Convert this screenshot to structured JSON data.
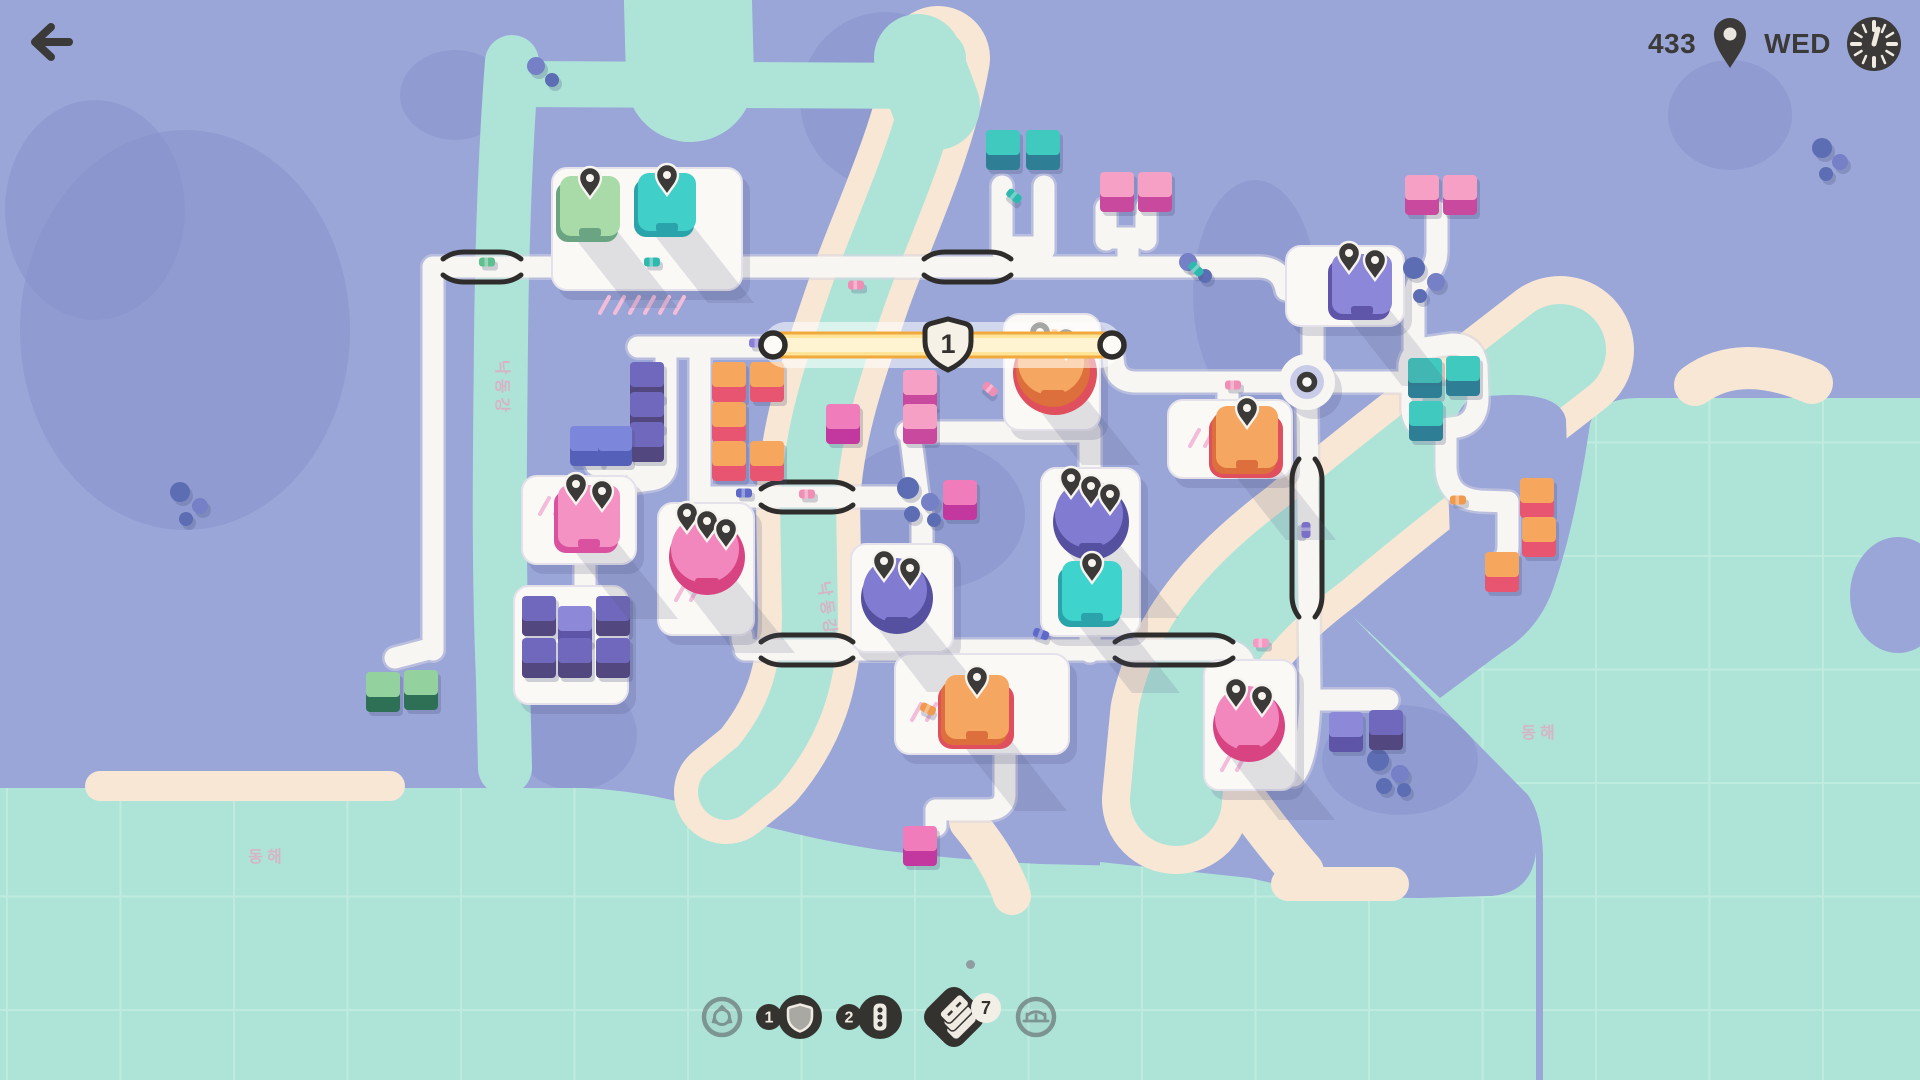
{
  "hud": {
    "back_glyph": "back-arrow",
    "pins_count": "433",
    "day": "WED"
  },
  "toolbar": {
    "items": [
      {
        "id": "roundabout-tool",
        "label": "Roundabout",
        "badge": "",
        "enabled": false
      },
      {
        "id": "motorway-tool",
        "label": "Motorway",
        "badge": "1",
        "enabled": true
      },
      {
        "id": "traffic-light-tool",
        "label": "Traffic Light",
        "badge": "2",
        "enabled": true
      },
      {
        "id": "road-tiles",
        "label": "Road Tiles",
        "badge": "7",
        "enabled": true
      },
      {
        "id": "bridge-tool",
        "label": "Bridge",
        "badge": "",
        "enabled": false
      }
    ]
  },
  "palette": {
    "land": "#9AA6D8",
    "hill": "#8690C9",
    "water": "#AEE4D8",
    "grid": "#C2EDE1",
    "sand": "#F7E7D4",
    "road": "#F8F6F2",
    "road_edge": "#D9D6E4",
    "lot": "#FBF9F6",
    "lot_stroke": "#E4E1EB",
    "dark": "#3B3A38",
    "rail": "#2E2D2B",
    "cream": "#F2EFE7",
    "label_pink": "#F295BC",
    "tree_a": "#5B6DB4",
    "tree_b": "#7480C6",
    "shadow_streak": "rgba(80,84,122,0.16)",
    "house_colors": {
      "pink": [
        "#F6A0C6",
        "#C8499E"
      ],
      "magenta": [
        "#F07CBC",
        "#C2399F"
      ],
      "orange": [
        "#F7A75D",
        "#E75570"
      ],
      "teal": [
        "#3FC9BE",
        "#2E7F96"
      ],
      "green": [
        "#93D19E",
        "#2F6F55"
      ],
      "indigo": [
        "#6F68BC",
        "#53477F"
      ],
      "purple": [
        "#8D88D8",
        "#5F55A8"
      ],
      "blue": [
        "#7B87DC",
        "#5560B8"
      ]
    },
    "dest_colors": {
      "green": [
        "#A9DBA8",
        "#6BA482"
      ],
      "teal": [
        "#41CFC9",
        "#2AA3AB"
      ],
      "tealSq": [
        "#3ED3CD",
        "#2AA3AB"
      ],
      "purple": [
        "#8C87D9",
        "#5F56A9"
      ],
      "purpleRd": [
        "#827BD2",
        "#55509F"
      ],
      "orange": [
        "#F5A660",
        "#DC6F3C"
      ],
      "pinkSq": [
        "#F592C4",
        "#D9519F"
      ],
      "pinkRd": [
        "#F287BE",
        "#D84381"
      ]
    }
  },
  "map": {
    "labels": [
      {
        "text": "동해",
        "x": 267,
        "y": 862,
        "rot": 0
      },
      {
        "text": "동해",
        "x": 1540,
        "y": 738,
        "rot": 0
      },
      {
        "text": "낙동강",
        "x": 497,
        "y": 388,
        "rot": 90
      },
      {
        "text": "낙동강",
        "x": 822,
        "y": 610,
        "rot": 82
      }
    ],
    "terrain": {
      "hills": [
        [
          185,
          330,
          165,
          200
        ],
        [
          95,
          210,
          90,
          110
        ],
        [
          885,
          100,
          85,
          88
        ],
        [
          1255,
          295,
          62,
          115
        ],
        [
          930,
          515,
          95,
          75
        ],
        [
          575,
          735,
          62,
          55
        ],
        [
          1400,
          760,
          78,
          55
        ],
        [
          1730,
          115,
          62,
          55
        ],
        [
          455,
          95,
          55,
          45
        ]
      ],
      "seas": [
        "M0,788 L585,788 Q655,792 715,812 Q800,838 880,850 Q960,860 1040,864 L1128,866 L1128,1080 L0,1080 Z",
        "M1100,1080 L1100,862 L1250,878 Q1330,898 1420,898 L1492,896 Q1532,892 1536,852 L1536,1080 Z",
        "M1352,616 L1528,795 Q1542,815 1543,855 L1543,1080 L1920,1080 L1920,398 L1640,398 Q1598,398 1590,424 Q1576,520 1556,580 Q1542,628 1502,652 L1440,698 Z"
      ],
      "sand": [
        {
          "d": "M938,58 C922,150 880,230 856,302 C830,378 812,432 808,502 L810,618 C809,680 793,724 758,766 L726,792",
          "w": 104
        },
        {
          "d": "M1560,350 C1470,420 1390,480 1312,546 C1240,600 1198,652 1184,716 L1176,800",
          "w": 148
        },
        {
          "d": "M100,786 L390,786",
          "w": 30
        },
        {
          "d": "M1288,884 L1392,884",
          "w": 34
        },
        {
          "d": "M1695,385 Q1740,352 1812,383",
          "w": 42
        },
        {
          "d": "M968,822 Q1000,860 1012,896",
          "w": 38
        },
        {
          "d": "M1238,790 Q1272,838 1302,872",
          "w": 44
        }
      ],
      "rivers": [
        {
          "d": "M512,62 C506,140 502,240 501,340 C500,450 498,560 503,680 L505,768",
          "w": 54
        },
        {
          "d": "M520,84 L930,86",
          "w": 46
        },
        {
          "d": "M688,2 L690,78",
          "w": 128
        },
        {
          "d": "M938,58 C922,150 880,230 856,302 C830,378 812,432 808,502 L810,618 C809,680 793,724 758,766 L726,792",
          "w": 56
        },
        {
          "d": "M918,58 L936,106",
          "w": 88
        },
        {
          "d": "M1560,350 C1470,420 1390,480 1312,546 C1240,600 1198,652 1184,716 L1176,800",
          "w": 92
        }
      ],
      "east_promontory": "M1472,398 Q1560,386 1566,420 Q1570,520 1554,580 Q1540,630 1498,638 Q1460,640 1452,600 L1448,480 Q1448,410 1472,398 Z",
      "right_blob": [
        1898,
        595,
        48,
        58
      ]
    },
    "trees": [
      [
        536,
        66,
        9
      ],
      [
        552,
        80,
        7
      ],
      [
        180,
        492,
        10
      ],
      [
        200,
        506,
        8
      ],
      [
        186,
        519,
        7
      ],
      [
        1414,
        268,
        11
      ],
      [
        1436,
        282,
        9
      ],
      [
        1420,
        296,
        7
      ],
      [
        908,
        488,
        11
      ],
      [
        930,
        502,
        9
      ],
      [
        912,
        514,
        8
      ],
      [
        934,
        520,
        7
      ],
      [
        1188,
        262,
        9
      ],
      [
        1205,
        276,
        7
      ],
      [
        1822,
        148,
        10
      ],
      [
        1840,
        162,
        8
      ],
      [
        1826,
        174,
        7
      ],
      [
        1378,
        760,
        11
      ],
      [
        1400,
        774,
        9
      ],
      [
        1384,
        786,
        8
      ],
      [
        1404,
        790,
        7
      ]
    ],
    "roads": [
      "M433,267 L1140,267",
      "M433,267 L433,650",
      "M433,648 L395,658",
      "M1002,186 L1002,250",
      "M1044,186 L1044,250",
      "M1002,247 L1044,247",
      "M1022,247 L1022,267",
      "M1106,208 L1106,240",
      "M1146,208 L1146,240",
      "M1106,238 L1146,238",
      "M1128,238 L1128,267",
      "M1140,267 L1258,267 Q1282,267 1286,290",
      "M1313,326 L1313,360",
      "M1281,382 L1136,382",
      "M1136,382 Q1118,382 1114,366 L1112,350",
      "M1333,382 L1410,382",
      "M1228,382 L1228,404",
      "M1412,384 Q1402,356 1424,348 L1452,344 Q1474,344 1477,366 L1478,398 Q1478,422 1458,427 L1434,430 Q1414,431 1412,410 Z",
      "M1446,430 L1446,466 Q1446,498 1480,501 L1508,502",
      "M1508,502 L1508,545 Q1508,560 1498,564",
      "M1437,212 L1437,250 Q1437,268 1424,276 Q1414,284 1414,302 L1414,348",
      "M1307,408 L1310,700",
      "M1310,700 L1388,700",
      "M1310,698 Q1308,760 1294,776",
      "M773,347 L638,347",
      "M666,347 L666,465",
      "M700,347 L700,506",
      "M666,465 L596,465",
      "M666,463 Q666,478 650,480 L636,482",
      "M700,504 Q700,516 690,518",
      "M705,497 L907,497",
      "M905,497 Q921,499 922,516 L922,546",
      "M907,432 L1090,432",
      "M910,432 L918,494",
      "M1090,432 L1090,470",
      "M1090,635 L1090,652",
      "M745,650 L1226,650",
      "M1226,650 Q1242,652 1245,666",
      "M985,650 L985,656",
      "M742,636 Q742,650 756,650",
      "M1005,752 L1005,794 Q1005,810 986,810 L936,810",
      "M936,810 L936,826",
      "M585,562 L585,590",
      "M773,345 L1112,345"
    ],
    "bridges": [
      {
        "o": "h",
        "x1": 450,
        "x2": 514,
        "y": 267
      },
      {
        "o": "h",
        "x1": 931,
        "x2": 1004,
        "y": 267
      },
      {
        "o": "h",
        "x1": 768,
        "x2": 846,
        "y": 497
      },
      {
        "o": "h",
        "x1": 768,
        "x2": 846,
        "y": 650
      },
      {
        "o": "h",
        "x1": 1122,
        "x2": 1226,
        "y": 650
      },
      {
        "o": "v",
        "x": 1307,
        "y1": 466,
        "y2": 610
      }
    ],
    "roundabout": {
      "cx": 1307,
      "cy": 382
    },
    "lots": [
      [
        552,
        168,
        190,
        122
      ],
      [
        1286,
        246,
        118,
        80
      ],
      [
        1168,
        400,
        124,
        78
      ],
      [
        1004,
        314,
        96,
        116
      ],
      [
        1041,
        468,
        99,
        168
      ],
      [
        851,
        544,
        102,
        108
      ],
      [
        522,
        476,
        114,
        88
      ],
      [
        658,
        503,
        96,
        132
      ],
      [
        895,
        654,
        174,
        100
      ],
      [
        1204,
        660,
        92,
        130
      ],
      [
        514,
        586,
        114,
        118
      ]
    ],
    "lot_decor": [
      {
        "x": 600,
        "y": 305,
        "n": 6
      },
      {
        "x": 1190,
        "y": 438,
        "n": 2
      },
      {
        "x": 540,
        "y": 506,
        "n": 2
      },
      {
        "x": 912,
        "y": 712,
        "n": 2
      },
      {
        "x": 676,
        "y": 592,
        "n": 2
      },
      {
        "x": 1222,
        "y": 762,
        "n": 2
      }
    ],
    "destinations": [
      {
        "shape": "sq",
        "x": 560,
        "y": 176,
        "s": 60,
        "c": "green",
        "pins": 1
      },
      {
        "shape": "sq",
        "x": 638,
        "y": 173,
        "s": 58,
        "c": "teal",
        "pins": 1
      },
      {
        "shape": "sq",
        "x": 1332,
        "y": 254,
        "s": 60,
        "c": "purple",
        "pins": 2
      },
      {
        "shape": "sq",
        "x": 1216,
        "y": 406,
        "s": 62,
        "c": "orange",
        "pins": 1,
        "ring": "#E04F5E"
      },
      {
        "shape": "rd",
        "cx": 1053,
        "cy": 366,
        "r": 37,
        "c": "orange",
        "pins": 2,
        "ring": "#E04F5E"
      },
      {
        "shape": "rd",
        "cx": 1091,
        "cy": 518,
        "r": 38,
        "c": "purpleRd",
        "pins": 3
      },
      {
        "shape": "sq",
        "x": 1062,
        "y": 561,
        "s": 60,
        "c": "tealSq",
        "pins": 1
      },
      {
        "shape": "rd",
        "cx": 897,
        "cy": 594,
        "r": 36,
        "c": "purpleRd",
        "pins": 2
      },
      {
        "shape": "sq",
        "x": 558,
        "y": 485,
        "s": 62,
        "c": "pinkSq",
        "pins": 2
      },
      {
        "shape": "rd",
        "cx": 707,
        "cy": 553,
        "r": 38,
        "c": "pinkRd",
        "pins": 3
      },
      {
        "shape": "sq",
        "x": 945,
        "y": 675,
        "s": 64,
        "c": "orange",
        "pins": 1,
        "ring": "#E04F5E"
      },
      {
        "shape": "rd",
        "cx": 1249,
        "cy": 722,
        "r": 36,
        "c": "pinkRd",
        "pins": 2
      }
    ],
    "houses": [
      [
        986,
        130,
        "teal"
      ],
      [
        1026,
        130,
        "teal"
      ],
      [
        1100,
        172,
        "pink"
      ],
      [
        1138,
        172,
        "pink"
      ],
      [
        1405,
        175,
        "pink"
      ],
      [
        1443,
        175,
        "pink"
      ],
      [
        712,
        362,
        "orange"
      ],
      [
        750,
        362,
        "orange"
      ],
      [
        712,
        402,
        "orange"
      ],
      [
        712,
        441,
        "orange"
      ],
      [
        750,
        441,
        "orange"
      ],
      [
        826,
        404,
        "magenta"
      ],
      [
        903,
        370,
        "pink"
      ],
      [
        903,
        404,
        "pink"
      ],
      [
        943,
        480,
        "magenta"
      ],
      [
        630,
        362,
        "indigo"
      ],
      [
        630,
        392,
        "indigo"
      ],
      [
        630,
        422,
        "indigo"
      ],
      [
        570,
        426,
        "blue"
      ],
      [
        598,
        426,
        "blue"
      ],
      [
        522,
        596,
        "indigo"
      ],
      [
        558,
        606,
        "purple"
      ],
      [
        596,
        596,
        "indigo"
      ],
      [
        522,
        638,
        "indigo"
      ],
      [
        558,
        638,
        "indigo"
      ],
      [
        596,
        638,
        "indigo"
      ],
      [
        366,
        672,
        "green"
      ],
      [
        404,
        670,
        "green"
      ],
      [
        903,
        826,
        "magenta"
      ],
      [
        1329,
        712,
        "purple"
      ],
      [
        1369,
        710,
        "indigo"
      ],
      [
        1520,
        478,
        "orange"
      ],
      [
        1522,
        517,
        "orange"
      ],
      [
        1485,
        552,
        "orange"
      ],
      [
        1408,
        358,
        "teal"
      ],
      [
        1446,
        356,
        "teal"
      ],
      [
        1409,
        401,
        "teal"
      ]
    ],
    "cars": [
      [
        652,
        262,
        0,
        "#2FB9AE"
      ],
      [
        487,
        262,
        0,
        "#5FBF8F"
      ],
      [
        1014,
        196,
        40,
        "#2FB9AE"
      ],
      [
        1196,
        269,
        45,
        "#2FB9AE"
      ],
      [
        856,
        285,
        0,
        "#F08FB6"
      ],
      [
        1233,
        385,
        0,
        "#F08FB6"
      ],
      [
        757,
        343,
        0,
        "#8A7FD6"
      ],
      [
        744,
        493,
        0,
        "#5E6AC8"
      ],
      [
        807,
        494,
        0,
        "#F08FB6"
      ],
      [
        1306,
        530,
        90,
        "#7A70C8"
      ],
      [
        1041,
        634,
        20,
        "#5E6AC8"
      ],
      [
        1261,
        643,
        0,
        "#F49BC4"
      ],
      [
        928,
        709,
        25,
        "#F09A4E"
      ],
      [
        1458,
        500,
        0,
        "#F09A4E"
      ],
      [
        990,
        389,
        40,
        "#F08FB6"
      ]
    ],
    "motorway": {
      "x1": 773,
      "x2": 1112,
      "y": 345,
      "label": "1",
      "shield_x": 948
    }
  }
}
